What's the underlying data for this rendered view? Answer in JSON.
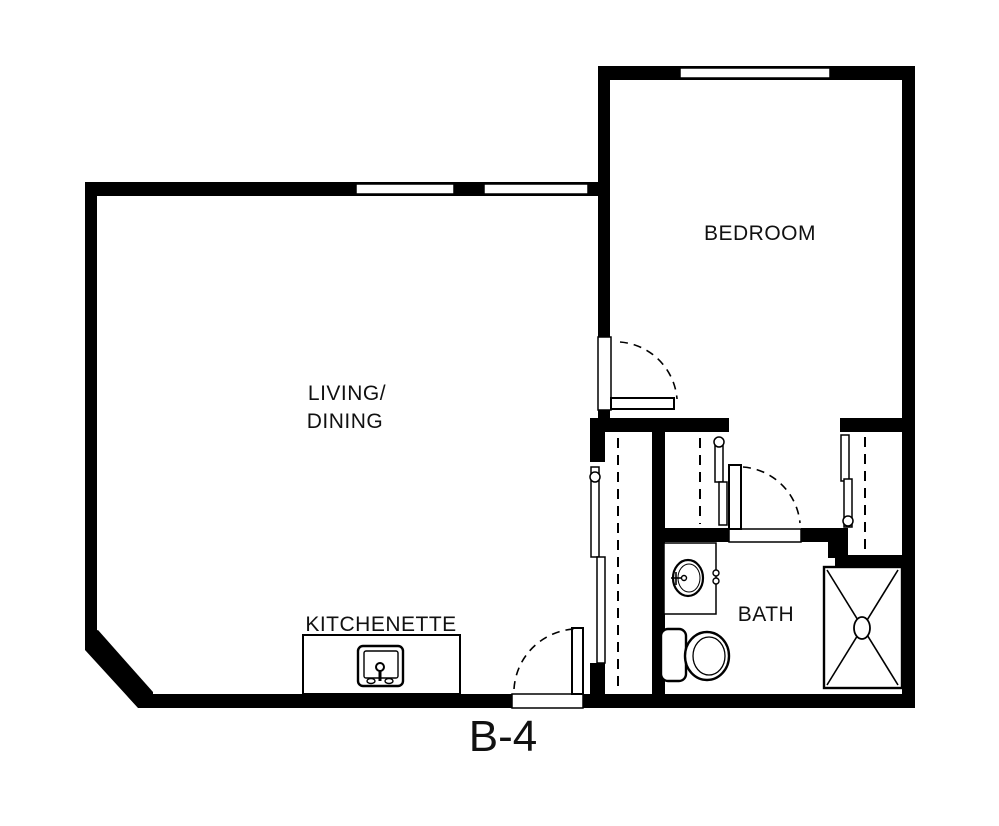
{
  "plan": {
    "unit": "B-4",
    "labels": {
      "bedroom": "BEDROOM",
      "living_line1": "LIVING/",
      "living_line2": "DINING",
      "kitchenette": "KITCHENETTE",
      "bath": "BATH"
    },
    "colors": {
      "walls": "#000000",
      "floor": "#ffffff",
      "text": "#111111"
    },
    "fixtures": [
      "kitchen-sink",
      "bathroom-sink-counter",
      "toilet",
      "shower",
      "closet-rod-left",
      "closet-rod-middle",
      "closet-rod-right"
    ],
    "doors": [
      "entry-door",
      "bedroom-door",
      "bath-door"
    ],
    "windows_count": 3
  }
}
